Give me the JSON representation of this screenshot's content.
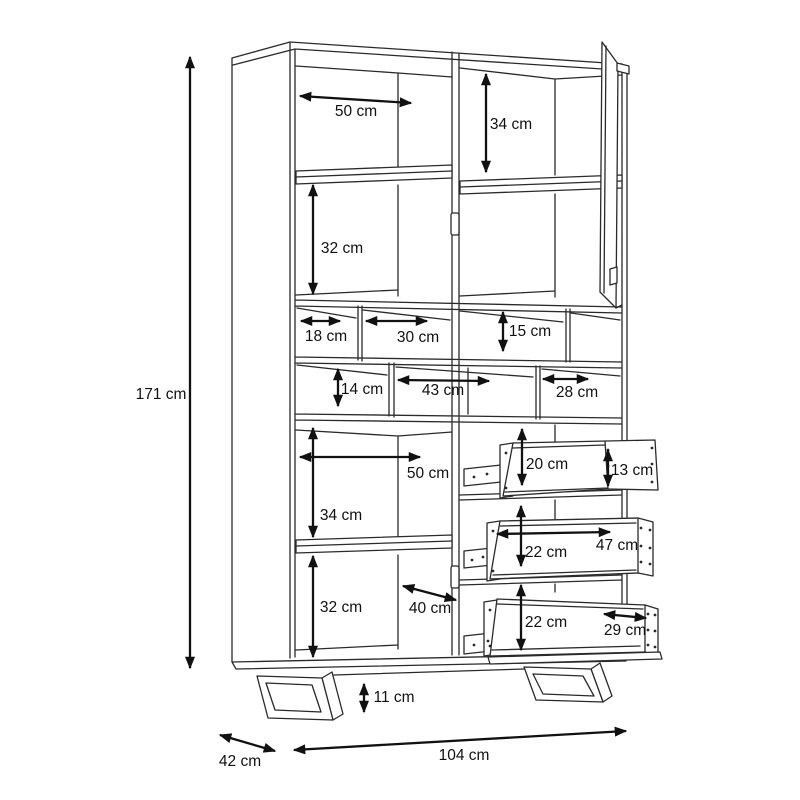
{
  "diagram": {
    "type": "furniture-technical-drawing",
    "subject": "tall display cabinet with open door, cubby compartments and three pull-out drawers on sled legs",
    "unit": "cm",
    "colors": {
      "line": "#2a2a2a",
      "dimension": "#111111",
      "background": "#ffffff"
    },
    "dimensions": {
      "overall_height": "171 cm",
      "overall_width": "104 cm",
      "overall_depth": "42 cm",
      "plinth_height": "11 cm",
      "upper_left_shelf_width": "50 cm",
      "upper_right_inner_height": "34 cm",
      "upper_left_lower_height": "32 cm",
      "cubby_top_left_width": "18 cm",
      "cubby_top_middle_width": "30 cm",
      "cubby_top_right_height": "15 cm",
      "cubby_bottom_left_height": "14 cm",
      "cubby_bottom_middle_width": "43 cm",
      "cubby_bottom_right_width": "28 cm",
      "lower_left_shelf_width": "50 cm",
      "lower_left_upper_height": "34 cm",
      "lower_left_lower_height": "32 cm",
      "lower_door_depth": "40 cm",
      "drawer1_height": "20 cm",
      "drawer1_front_height": "13 cm",
      "drawer2_height": "22 cm",
      "drawer2_inner_width": "47 cm",
      "drawer3_height": "22 cm",
      "drawer3_inner_width": "29 cm"
    }
  }
}
